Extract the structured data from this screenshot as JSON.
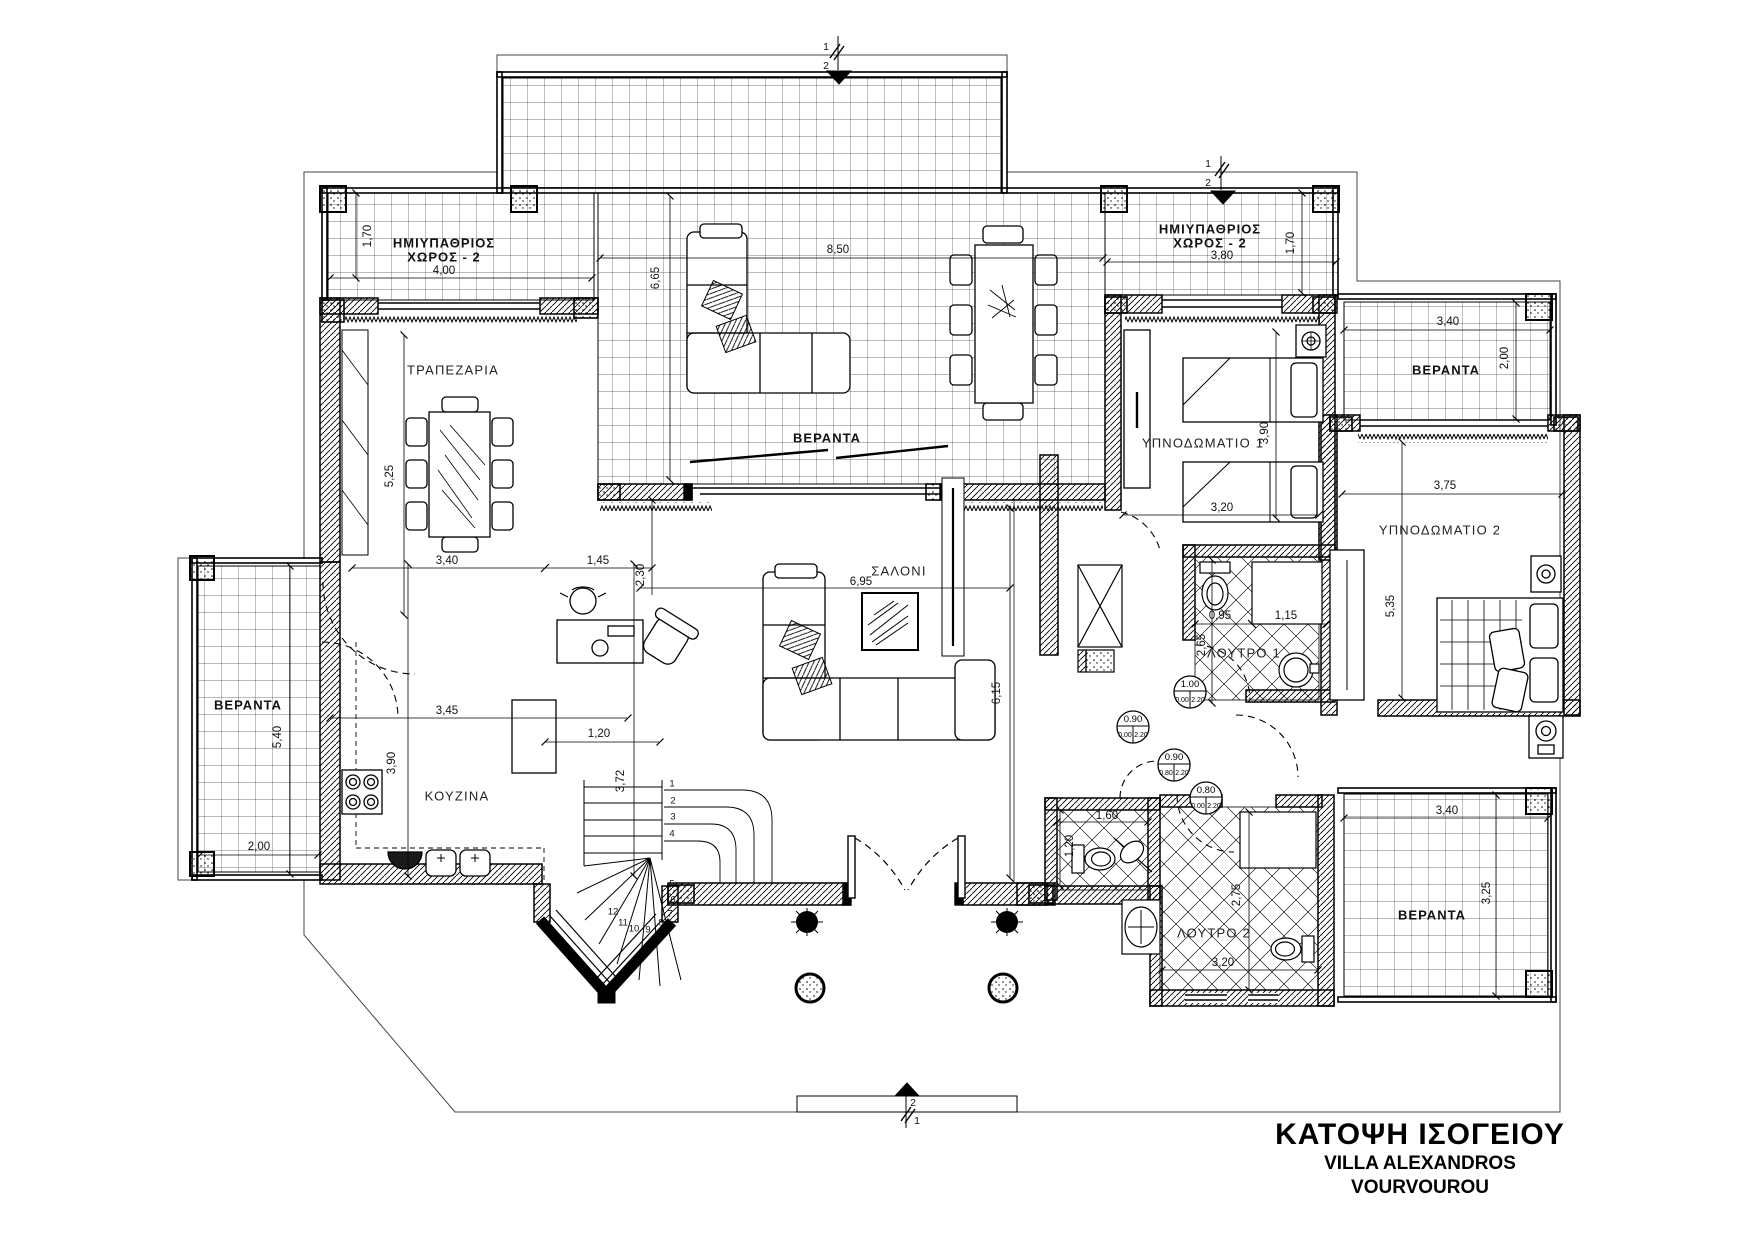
{
  "title_block": {
    "line1": "ΚΑΤΟΨΗ ΙΣΟΓΕΙΟΥ",
    "line2": "VILLA ALEXANDROS",
    "line3": "VOURVOUROU"
  },
  "labels": [
    {
      "t": "ΗΜΙΥΠΑΘΡΙΟΣ",
      "x": 444,
      "y": 243,
      "c": "roomb",
      "n": "room-label-hmiypathrios-choros-2-left"
    },
    {
      "t": "ΧΩΡΟΣ - 2",
      "x": 444,
      "y": 257,
      "c": "roomb",
      "n": "room-label-hmiypathrios-choros-2-left-line2"
    },
    {
      "t": "4,00",
      "x": 444,
      "y": 271,
      "c": "dim"
    },
    {
      "t": "1,70",
      "x": 368,
      "y": 236,
      "c": "dim",
      "r": 1
    },
    {
      "t": "8,50",
      "x": 838,
      "y": 250,
      "c": "dim"
    },
    {
      "t": "6,65",
      "x": 656,
      "y": 278,
      "c": "dim",
      "r": 1
    },
    {
      "t": "ΗΜΙΥΠΑΘΡΙΟΣ",
      "x": 1210,
      "y": 229,
      "c": "roomb",
      "n": "room-label-hmiypathrios-choros-2-right"
    },
    {
      "t": "ΧΩΡΟΣ - 2",
      "x": 1210,
      "y": 243,
      "c": "roomb",
      "n": "room-label-hmiypathrios-choros-2-right-line2"
    },
    {
      "t": "3,80",
      "x": 1222,
      "y": 256,
      "c": "dim"
    },
    {
      "t": "1,70",
      "x": 1291,
      "y": 243,
      "c": "dim",
      "r": 1
    },
    {
      "t": "ΒΕΡΑΝΤΑ",
      "x": 827,
      "y": 438,
      "c": "roomb",
      "n": "room-label-veranda-center"
    },
    {
      "t": "ΤΡΑΠΕΖΑΡΙΑ",
      "x": 453,
      "y": 370,
      "c": "room",
      "n": "room-label-trapezaria"
    },
    {
      "t": "5,25",
      "x": 390,
      "y": 476,
      "c": "dim",
      "r": 1
    },
    {
      "t": "3,40",
      "x": 447,
      "y": 561,
      "c": "dim"
    },
    {
      "t": "1,45",
      "x": 598,
      "y": 561,
      "c": "dim"
    },
    {
      "t": "2,30",
      "x": 641,
      "y": 575,
      "c": "dim",
      "r": 1
    },
    {
      "t": "ΣΑΛΟΝΙ",
      "x": 899,
      "y": 571,
      "c": "room",
      "n": "room-label-saloni"
    },
    {
      "t": "6,95",
      "x": 861,
      "y": 582,
      "c": "dim"
    },
    {
      "t": "6,15",
      "x": 997,
      "y": 693,
      "c": "dim",
      "r": 1
    },
    {
      "t": "ΚΟΥΖΙΝΑ",
      "x": 457,
      "y": 796,
      "c": "room",
      "n": "room-label-kouzina"
    },
    {
      "t": "3,45",
      "x": 447,
      "y": 711,
      "c": "dim"
    },
    {
      "t": "1,20",
      "x": 599,
      "y": 734,
      "c": "dim"
    },
    {
      "t": "3,90",
      "x": 392,
      "y": 763,
      "c": "dim",
      "r": 1
    },
    {
      "t": "3,72",
      "x": 621,
      "y": 781,
      "c": "dim",
      "r": 1
    },
    {
      "t": "ΒΕΡΑΝΤΑ",
      "x": 248,
      "y": 705,
      "c": "roomb",
      "n": "room-label-veranda-left"
    },
    {
      "t": "5,40",
      "x": 278,
      "y": 737,
      "c": "dim",
      "r": 1
    },
    {
      "t": "2,00",
      "x": 259,
      "y": 847,
      "c": "dim"
    },
    {
      "t": "ΥΠΝΟΔΩΜΑΤΙΟ 1",
      "x": 1203,
      "y": 443,
      "c": "room",
      "n": "room-label-ypnodomatio-1"
    },
    {
      "t": "3,90",
      "x": 1265,
      "y": 433,
      "c": "dim",
      "r": 1
    },
    {
      "t": "3,20",
      "x": 1222,
      "y": 508,
      "c": "dim"
    },
    {
      "t": "ΒΕΡΑΝΤΑ",
      "x": 1446,
      "y": 370,
      "c": "roomb",
      "n": "room-label-veranda-top-right"
    },
    {
      "t": "3,40",
      "x": 1448,
      "y": 322,
      "c": "dim"
    },
    {
      "t": "2,00",
      "x": 1505,
      "y": 358,
      "c": "dim",
      "r": 1
    },
    {
      "t": "ΥΠΝΟΔΩΜΑΤΙΟ 2",
      "x": 1440,
      "y": 530,
      "c": "room",
      "n": "room-label-ypnodomatio-2"
    },
    {
      "t": "3,75",
      "x": 1445,
      "y": 486,
      "c": "dim"
    },
    {
      "t": "5,35",
      "x": 1391,
      "y": 606,
      "c": "dim",
      "r": 1
    },
    {
      "t": "ΛΟΥΤΡΟ 1",
      "x": 1244,
      "y": 653,
      "c": "room",
      "n": "room-label-loutro-1"
    },
    {
      "t": "0,95",
      "x": 1220,
      "y": 616,
      "c": "dim"
    },
    {
      "t": "1,15",
      "x": 1286,
      "y": 616,
      "c": "dim"
    },
    {
      "t": "2,65",
      "x": 1202,
      "y": 645,
      "c": "dim",
      "r": 1
    },
    {
      "t": "1,60",
      "x": 1107,
      "y": 816,
      "c": "dim"
    },
    {
      "t": "1,20",
      "x": 1070,
      "y": 846,
      "c": "dim",
      "r": 1
    },
    {
      "t": "ΛΟΥΤΡΟ 2",
      "x": 1214,
      "y": 933,
      "c": "room",
      "n": "room-label-loutro-2"
    },
    {
      "t": "2,75",
      "x": 1237,
      "y": 895,
      "c": "dim",
      "r": 1
    },
    {
      "t": "3,20",
      "x": 1223,
      "y": 963,
      "c": "dim"
    },
    {
      "t": "ΒΕΡΑΝΤΑ",
      "x": 1432,
      "y": 915,
      "c": "roomb",
      "n": "room-label-veranda-bottom-right"
    },
    {
      "t": "3,40",
      "x": 1447,
      "y": 811,
      "c": "dim"
    },
    {
      "t": "3,25",
      "x": 1487,
      "y": 893,
      "c": "dim",
      "r": 1
    },
    {
      "t": "1",
      "x": 672,
      "y": 784,
      "c": "step"
    },
    {
      "t": "2",
      "x": 673,
      "y": 801,
      "c": "step"
    },
    {
      "t": "3",
      "x": 673,
      "y": 817,
      "c": "step"
    },
    {
      "t": "4",
      "x": 672,
      "y": 834,
      "c": "step"
    },
    {
      "t": "5",
      "x": 672,
      "y": 884,
      "c": "step"
    },
    {
      "t": "6",
      "x": 673,
      "y": 900,
      "c": "step"
    },
    {
      "t": "7",
      "x": 670,
      "y": 914,
      "c": "step"
    },
    {
      "t": "8",
      "x": 661,
      "y": 923,
      "c": "step"
    },
    {
      "t": "9",
      "x": 648,
      "y": 930,
      "c": "step"
    },
    {
      "t": "10",
      "x": 634,
      "y": 929,
      "c": "step"
    },
    {
      "t": "11",
      "x": 623,
      "y": 923,
      "c": "step"
    },
    {
      "t": "12",
      "x": 613,
      "y": 912,
      "c": "step"
    },
    {
      "t": "1",
      "x": 826,
      "y": 47,
      "c": "mark",
      "n": "section-marker-top-1"
    },
    {
      "t": "2",
      "x": 826,
      "y": 66,
      "c": "mark",
      "n": "section-marker-top-2"
    },
    {
      "t": "1",
      "x": 1208,
      "y": 164,
      "c": "mark",
      "n": "section-marker-right-1"
    },
    {
      "t": "2",
      "x": 1208,
      "y": 183,
      "c": "mark",
      "n": "section-marker-right-2"
    },
    {
      "t": "2",
      "x": 913,
      "y": 1103,
      "c": "mark",
      "n": "section-marker-bottom-2"
    },
    {
      "t": "1",
      "x": 917,
      "y": 1121,
      "c": "mark",
      "n": "section-marker-bottom-1"
    }
  ],
  "door_tags": [
    {
      "w": "1.00",
      "a": "0.00",
      "b": "2.20",
      "x": 1190,
      "y": 692
    },
    {
      "w": "0.90",
      "a": "0.00",
      "b": "2.20",
      "x": 1133,
      "y": 727
    },
    {
      "w": "0.90",
      "a": "0.80",
      "b": "2.20",
      "x": 1174,
      "y": 765
    },
    {
      "w": "0.80",
      "a": "0.00",
      "b": "2.20",
      "x": 1206,
      "y": 798
    }
  ]
}
